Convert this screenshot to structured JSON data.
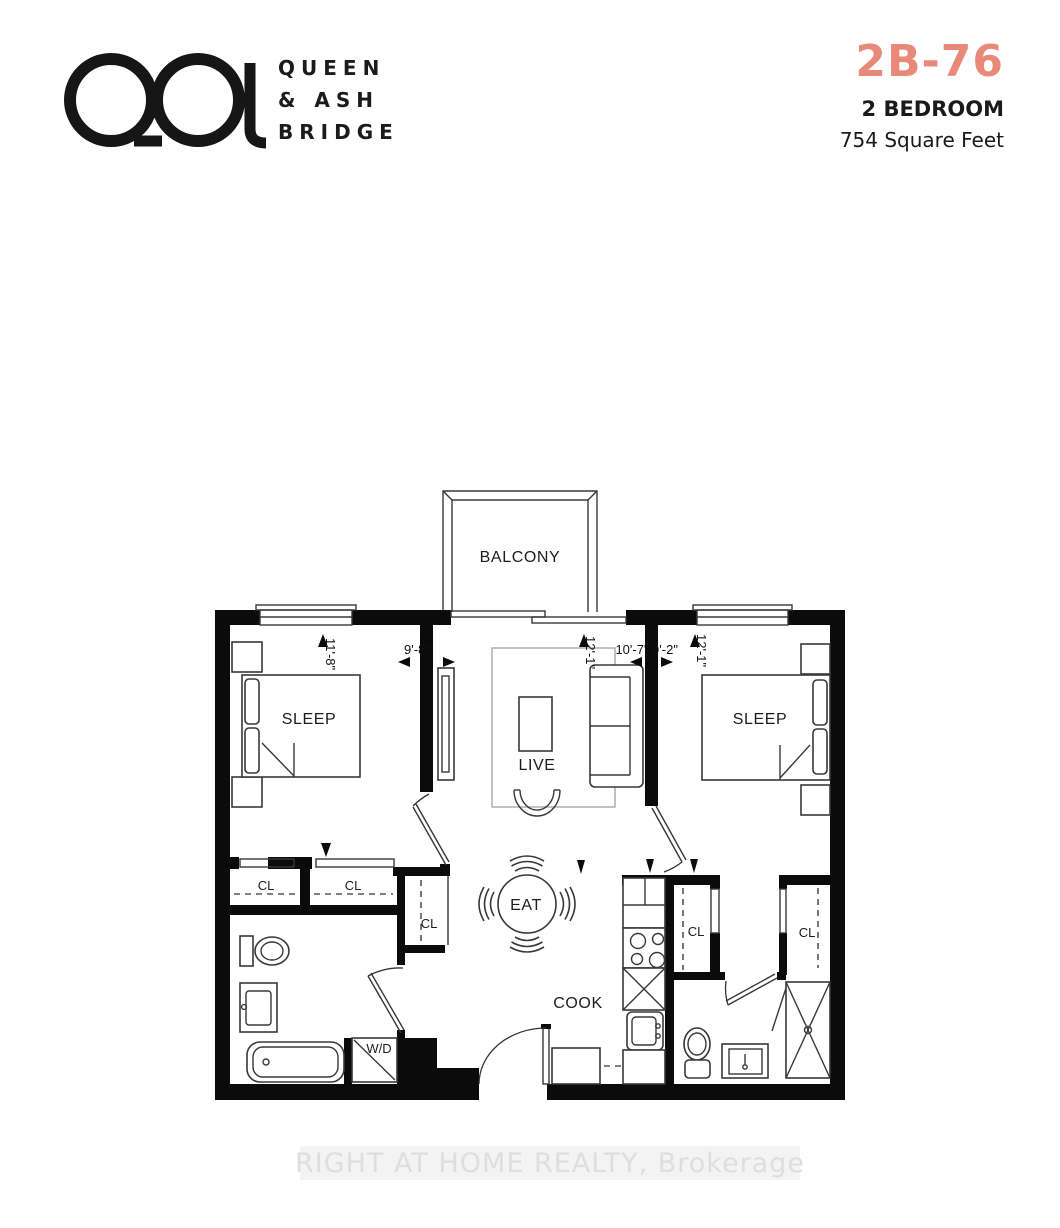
{
  "brand": {
    "name_line1": "QUEEN",
    "name_line2": "& ASH",
    "name_line3": "BRIDGE"
  },
  "unit": {
    "code": "2B-76",
    "type": "2 BEDROOM",
    "area": "754 Square Feet"
  },
  "colors": {
    "accent": "#E9897A",
    "ink": "#1b1b1b",
    "watermark_text": "#dedede"
  },
  "floorplan": {
    "labels": {
      "balcony": "BALCONY",
      "sleep_left": "SLEEP",
      "sleep_right": "SLEEP",
      "live": "LIVE",
      "eat": "EAT",
      "cook": "COOK",
      "washer_dryer": "W/D",
      "closets": [
        "CL",
        "CL",
        "CL",
        "CL",
        "CL"
      ]
    },
    "dimensions": {
      "sleep_left_width": "11'-8\"",
      "sleep_left_depth": "9'-8\"",
      "live_width": "12'-1\"",
      "live_depth": "10'-7\"",
      "foyer_width": "9'-2\"",
      "sleep_right_width": "12'-1\""
    }
  },
  "watermark": "RIGHT AT HOME REALTY, Brokerage"
}
